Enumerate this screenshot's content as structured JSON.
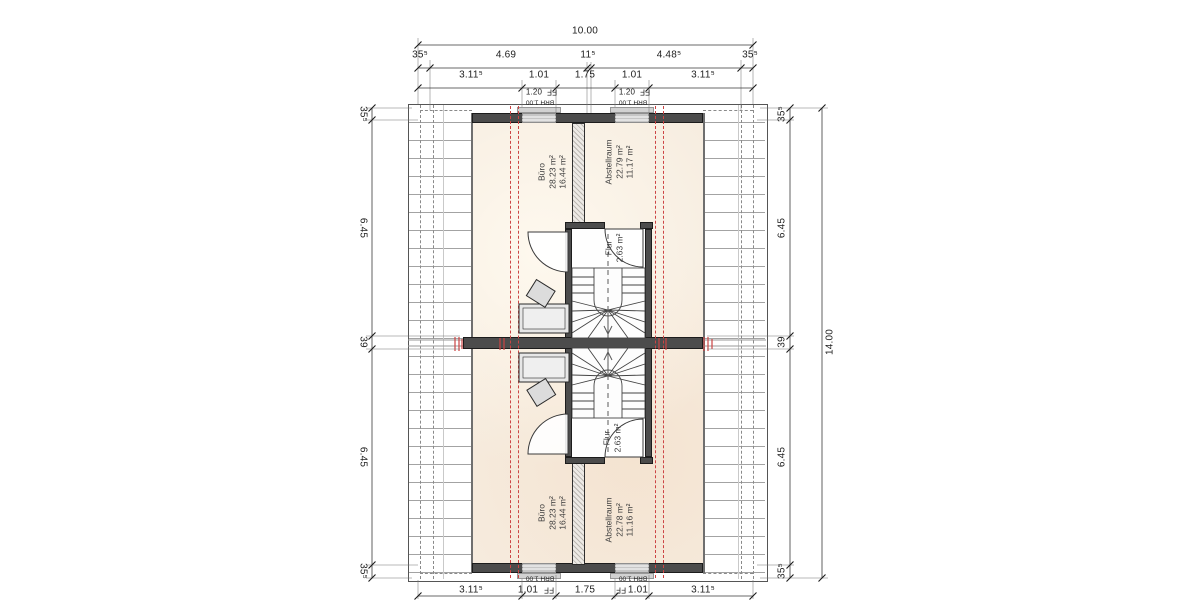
{
  "rooms": {
    "unit_top": {
      "buero": {
        "name": "Büro",
        "area_total": "28.23 m²",
        "area_living": "16.44 m²"
      },
      "abstellraum": {
        "name": "Abstellraum",
        "area_total": "22.79 m²",
        "area_living": "11.17 m²"
      },
      "flur": {
        "name": "Flur",
        "area": "2.63 m²"
      }
    },
    "unit_bottom": {
      "buero": {
        "name": "Büro",
        "area_total": "28.23 m²",
        "area_living": "16.44 m²"
      },
      "abstellraum": {
        "name": "Abstellraum",
        "area_total": "22.78 m²",
        "area_living": "11.16 m²"
      },
      "flur": {
        "name": "Flur",
        "area": "2.63 m²"
      }
    }
  },
  "windows": {
    "width": "1.20",
    "ff": "FF",
    "sill": "BRH 1.00"
  },
  "dims": {
    "top": {
      "overall": "10.00",
      "row2": [
        "35⁵",
        "4.69",
        "11⁵",
        "4.48⁵",
        "35⁵"
      ],
      "row3": [
        "3.11⁵",
        "1.01",
        "1.75",
        "1.01",
        "3.11⁵"
      ]
    },
    "bottom": {
      "row": [
        "3.11⁵",
        "1.01",
        "1.75",
        "1.01",
        "3.11⁵"
      ]
    },
    "right": {
      "overall": "14.00",
      "chain": [
        "35⁵",
        "6.45",
        "39",
        "6.45",
        "35⁵"
      ]
    },
    "left": {
      "chain": [
        "35⁵",
        "6.45",
        "39",
        "6.45",
        "35⁵"
      ]
    }
  },
  "colors": {
    "wall": "#4c4c4c",
    "floor": "#f6ecdf",
    "height_line_red": "#cc4444",
    "window": "#c6c6c6"
  }
}
